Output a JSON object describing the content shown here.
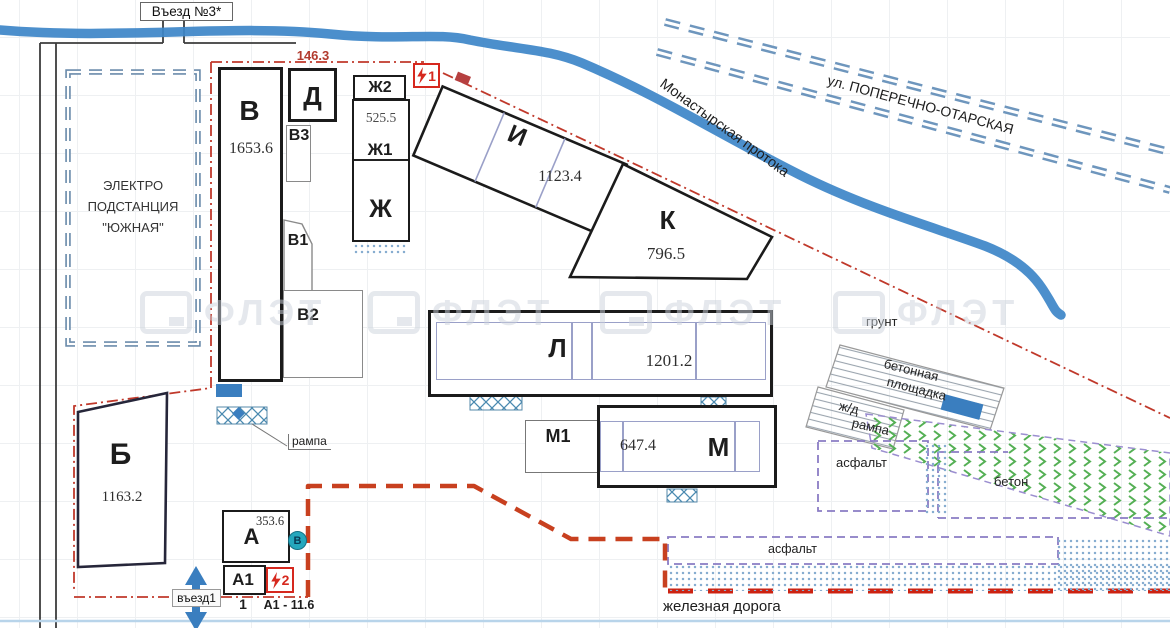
{
  "title_labels": {
    "entrance3": "Въезд №3*",
    "entrance1": "въезд1",
    "river": "Монастырская протока",
    "street": "ул. ПОПЕРЕЧНО-ОТАРСКАЯ",
    "railway": "железная дорога",
    "watermark": "ФЛЭТ"
  },
  "substation": {
    "line1": "ЭЛЕКТРО",
    "line2": "ПОДСТАНЦИЯ",
    "line3": "\"ЮЖНАЯ\""
  },
  "boundary": {
    "length_top": "146.3"
  },
  "buildings": {
    "v": {
      "label": "В",
      "area": "1653.6"
    },
    "d": {
      "label": "Д"
    },
    "v3": {
      "label": "В3"
    },
    "v1": {
      "label": "В1"
    },
    "v2": {
      "label": "В2"
    },
    "zh2": {
      "label": "Ж2"
    },
    "zh1": {
      "label": "Ж1",
      "area": "525.5"
    },
    "zh": {
      "label": "Ж"
    },
    "i": {
      "label": "И",
      "area": "1123.4"
    },
    "k": {
      "label": "К",
      "area": "796.5"
    },
    "l": {
      "label": "Л",
      "area": "1201.2"
    },
    "m1": {
      "label": "М1"
    },
    "m": {
      "label": "М",
      "area": "647.4"
    },
    "b": {
      "label": "Б",
      "area": "1163.2"
    },
    "a": {
      "label": "А",
      "area": "353.6"
    },
    "a1": {
      "label": "А1",
      "area_note": "А1 - 11.6"
    }
  },
  "markers": {
    "bolt1": "1",
    "bolt2": "2",
    "point1": "1",
    "circle_b": "В"
  },
  "surfaces": {
    "ground": "грунт",
    "concrete_pad1": "бетонная",
    "concrete_pad2": "площадка",
    "rail_ramp1": "ж/д",
    "rail_ramp2": "рампа",
    "asphalt_box": "асфальт",
    "concrete": "бетон",
    "asphalt_strip": "асфальт",
    "ramp": "рампа"
  },
  "colors": {
    "river": "#3d85c8",
    "street": "#6e96bd",
    "boundary_red": "#c8401f",
    "dashdot_red": "#c0392b",
    "accent_blue": "#3a7ebf",
    "green": "#55b055",
    "purple_dash": "#8a7cc4",
    "teal": "#25a7bd"
  }
}
